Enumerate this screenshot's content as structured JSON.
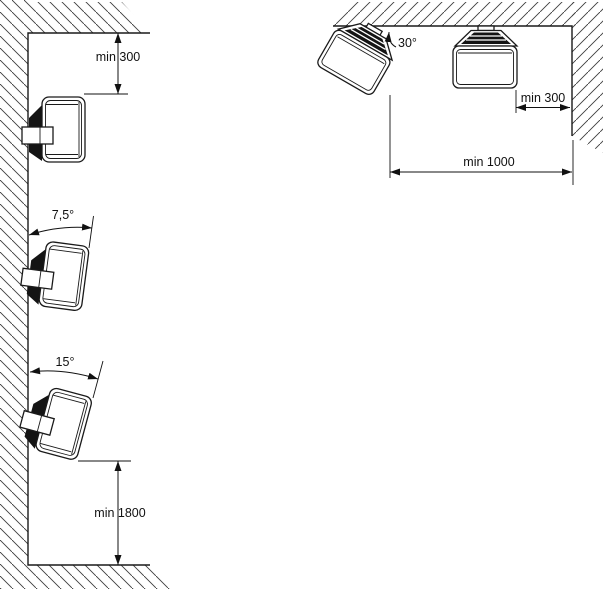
{
  "diagram": {
    "wall_panel": {
      "labels": {
        "top_clearance": "min 300",
        "tilt_small": "7,5°",
        "tilt_large": "15°",
        "bottom_clearance": "min 1800"
      }
    },
    "ceiling_panel": {
      "labels": {
        "tilt": "30°",
        "side_clearance": "min 300",
        "corner_clearance": "min 1000"
      }
    },
    "colors": {
      "line": "#1a1a1a",
      "background": "#ffffff"
    }
  }
}
